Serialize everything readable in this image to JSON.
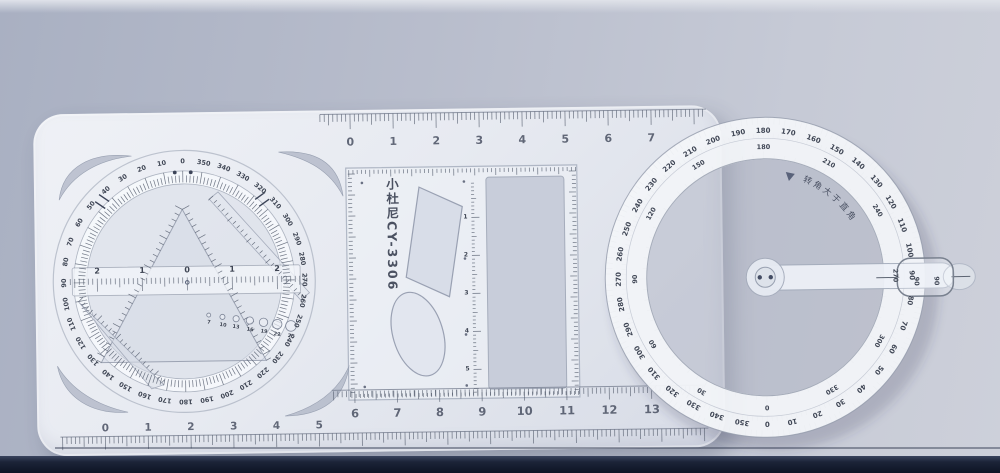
{
  "scene": {
    "description": "Photograph of a multifunctional geometric drawing template ruler (white translucent plastic) lying on a blue-gray desk, with a rotating degree dial on the left, a stencil square in the middle and a circular protractor ring with a swing arm on the right"
  },
  "brand": {
    "label": "小杜尼CY-3306"
  },
  "rulers": {
    "top_edge": {
      "numbers": [
        "0",
        "1",
        "2",
        "3",
        "4",
        "5",
        "6",
        "7"
      ]
    },
    "middle": {
      "numbers": [
        "6",
        "7",
        "8",
        "9",
        "10",
        "11",
        "12",
        "13"
      ]
    },
    "bottom_edge": {
      "numbers": [
        "0",
        "1",
        "2",
        "3",
        "4",
        "5"
      ]
    },
    "dial_center": {
      "numbers": [
        "2",
        "1",
        "0",
        "1",
        "2"
      ]
    },
    "square_vertical": {
      "numbers": [
        "1",
        "2",
        "3",
        "4",
        "5"
      ]
    }
  },
  "hole_gauge": {
    "labels": [
      "7",
      "10",
      "13",
      "16",
      "19",
      "22",
      "25"
    ]
  },
  "left_dial": {
    "degree_labels": [
      "0",
      "10",
      "20",
      "30",
      "40",
      "50",
      "60",
      "70",
      "80",
      "90",
      "100",
      "110",
      "120",
      "130",
      "140",
      "150",
      "160",
      "170",
      "180",
      "190",
      "200",
      "210",
      "220",
      "230",
      "240",
      "250",
      "260",
      "270",
      "280",
      "290",
      "300",
      "310",
      "320",
      "330",
      "340",
      "350"
    ]
  },
  "right_ring": {
    "outer_labels": [
      "0",
      "10",
      "20",
      "30",
      "40",
      "50",
      "60",
      "70",
      "80",
      "90",
      "100",
      "110",
      "120",
      "130",
      "140",
      "150",
      "160",
      "170",
      "180",
      "190",
      "200",
      "210",
      "220",
      "230",
      "240",
      "250",
      "260",
      "270",
      "280",
      "290",
      "300",
      "310",
      "320",
      "330",
      "340",
      "350"
    ],
    "inner_labels": [
      "0",
      "30",
      "60",
      "90",
      "120",
      "150",
      "180",
      "210",
      "240",
      "270",
      "300",
      "330"
    ],
    "note": "转角大于直角",
    "cursor_values": [
      "90",
      "90"
    ]
  }
}
